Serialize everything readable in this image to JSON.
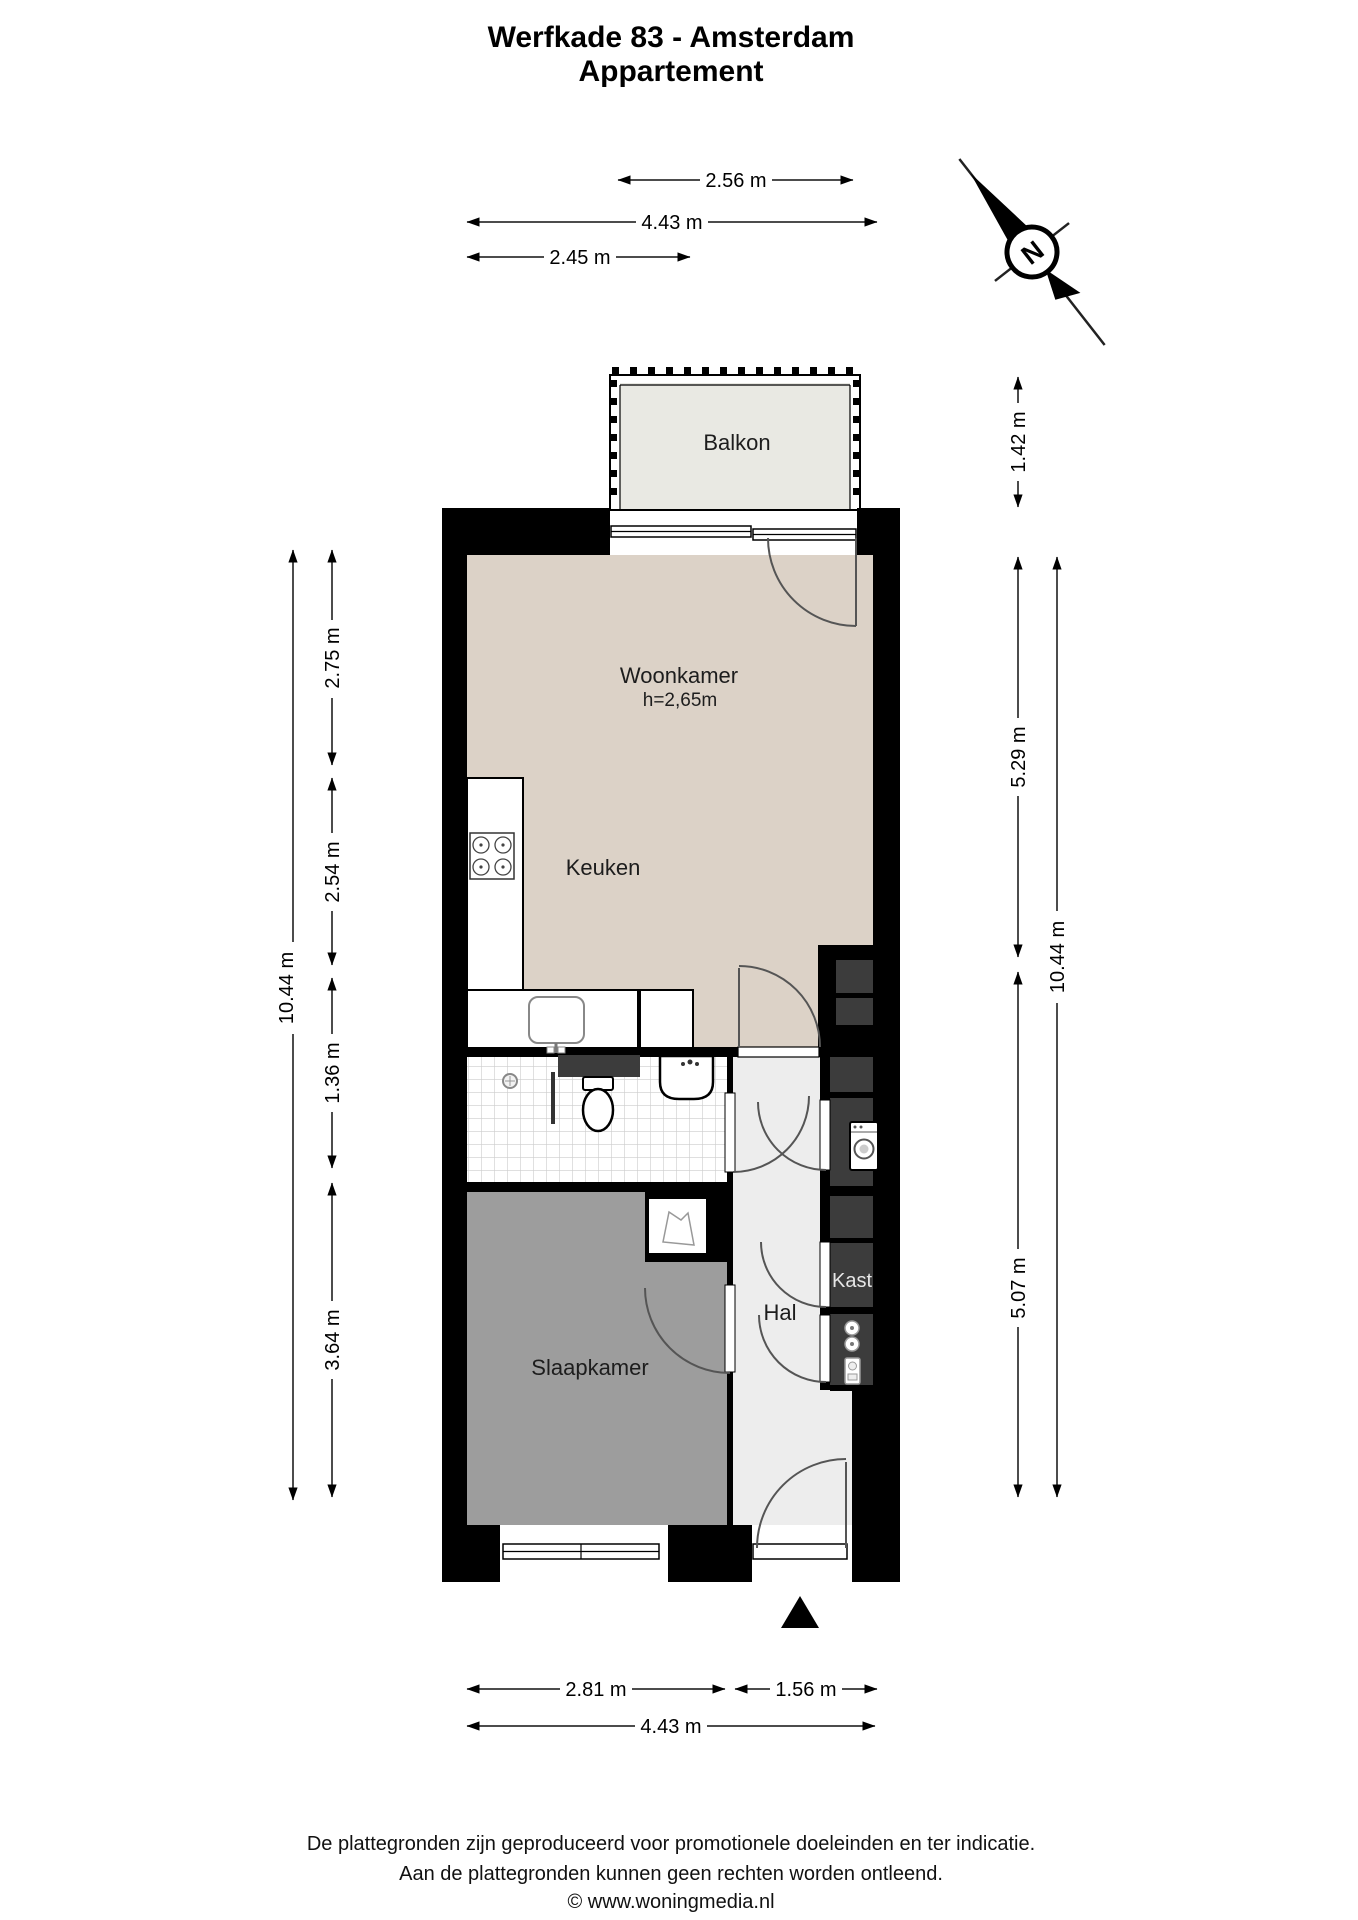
{
  "title": {
    "line1": "Werfkade 83 - Amsterdam",
    "line2": "Appartement"
  },
  "compass": {
    "north_label": "N"
  },
  "rooms": {
    "balkon": "Balkon",
    "woonkamer": "Woonkamer",
    "woonkamer_height": "h=2,65m",
    "keuken": "Keuken",
    "hal": "Hal",
    "kast": "Kast",
    "slaapkamer": "Slaapkamer"
  },
  "dimensions": {
    "top": [
      {
        "label": "2.56 m"
      },
      {
        "label": "4.43 m"
      },
      {
        "label": "2.45 m"
      }
    ],
    "left_outer": {
      "label": "10.44 m"
    },
    "left_inner": [
      {
        "label": "2.75 m"
      },
      {
        "label": "2.54 m"
      },
      {
        "label": "1.36 m"
      },
      {
        "label": "3.64 m"
      }
    ],
    "right_outer": {
      "label": "10.44 m"
    },
    "right_inner": [
      {
        "label": "1.42 m"
      },
      {
        "label": "5.29 m"
      },
      {
        "label": "5.07 m"
      }
    ],
    "bottom": [
      {
        "label": "2.81 m"
      },
      {
        "label": "1.56 m"
      },
      {
        "label": "4.43 m"
      }
    ]
  },
  "footer": {
    "line1": "De plattegronden zijn geproduceerd voor promotionele doeleinden en ter indicatie.",
    "line2": "Aan de plattegronden kunnen geen rechten worden ontleend.",
    "line3": "© www.woningmedia.nl"
  },
  "colors": {
    "wall": "#000000",
    "living_floor": "#dcd2c7",
    "balcony_floor": "#e9e9e3",
    "hall_floor": "#ededed",
    "bedroom_floor": "#9d9d9d",
    "closet_fill": "#3c3c3c",
    "tile_line": "#cccccc"
  }
}
